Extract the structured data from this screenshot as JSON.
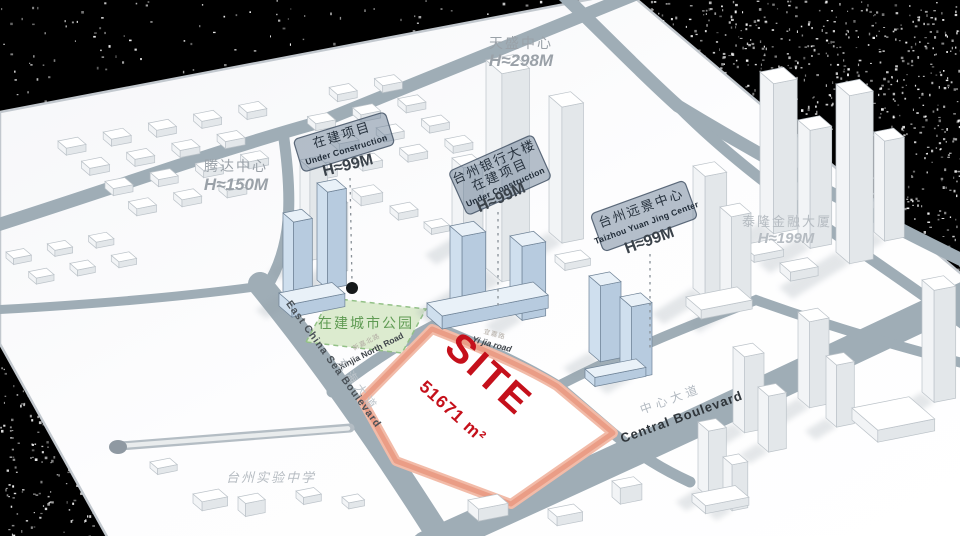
{
  "site": {
    "label": "SITE",
    "area": "51671 m²"
  },
  "park": {
    "label": "在建城市公园"
  },
  "school": {
    "label": "台州实验中学"
  },
  "landmarks": {
    "tiansheng": {
      "name": "天盛中心",
      "height": "H≈298M"
    },
    "tengda": {
      "name": "腾达中心",
      "height": "H≈150M"
    },
    "tailong": {
      "name": "泰隆金融大厦",
      "height": "H≈199M"
    }
  },
  "plaques": {
    "under_construction": {
      "line1": "在建项目",
      "line2": "Under Construction",
      "height": "H≈99M"
    },
    "taizhou_bank": {
      "line1": "台州银行大楼",
      "line2": "在建项目",
      "line3": "Under Construction",
      "height": "H≈99M"
    },
    "yuanjing": {
      "line1": "台州远景中心",
      "line2": "Taizhou Yuan Jing Center",
      "height": "H≈99M"
    }
  },
  "roads": {
    "xinjia": {
      "zh": "新嘉北路",
      "en": "Xinjia North Road"
    },
    "yijia": {
      "zh": "宜嘉路",
      "en": "Yi jia road"
    },
    "east_china_sea": {
      "zh": "东海大道",
      "en": "East China Sea Boulevard"
    },
    "central": {
      "zh": "中心大道",
      "en": "Central Boulevard"
    }
  },
  "colors": {
    "site_red": "#c5101b",
    "site_border": "#ea9d86",
    "park_green": "#5f9b53",
    "road_gray": "#9fadb6",
    "building_blue": "#cfdfee",
    "background": "#000000"
  }
}
